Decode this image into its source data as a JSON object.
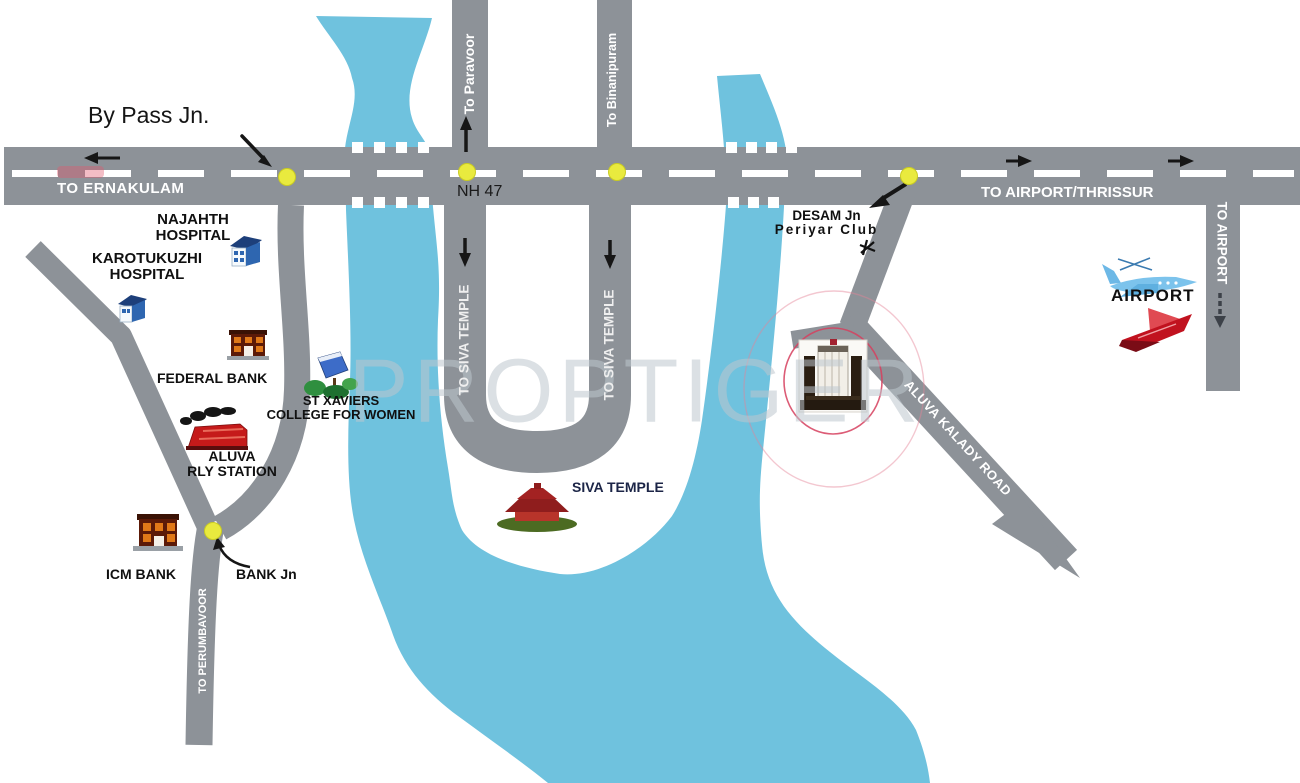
{
  "watermark": "PROPTIGER",
  "roads": {
    "highway_name": "NH 47",
    "labels": {
      "to_ernakulam": "TO ERNAKULAM",
      "to_airport_thrissur": "TO AIRPORT/THRISSUR",
      "to_paravoor": "To Paravoor",
      "to_binanipuram": "To Binanipuram",
      "to_siva_temple": "TO SIVA TEMPLE",
      "to_perumbavoor": "TO PERUMBAVOOR",
      "to_airport": "TO AIRPORT",
      "aluva_kalady_road": "ALUVA KALADY ROAD"
    }
  },
  "junctions": {
    "by_pass": "By Pass Jn.",
    "bank": "BANK Jn",
    "desam_line1": "DESAM Jn",
    "desam_line2": "Periyar Club"
  },
  "places": {
    "najahth_line1": "NAJAHTH",
    "najahth_line2": "HOSPITAL",
    "karotukuzhi_line1": "KAROTUKUZHI",
    "karotukuzhi_line2": "HOSPITAL",
    "federal_bank": "FEDERAL BANK",
    "st_xaviers_line1": "ST XAVIERS",
    "st_xaviers_line2": "COLLEGE FOR WOMEN",
    "aluva_rly_line1": "ALUVA",
    "aluva_rly_line2": "RLY STATION",
    "icm_bank": "ICM BANK",
    "siva_temple": "SIVA TEMPLE",
    "airport": "AIRPORT"
  },
  "icons": {
    "najahth-hospital-icon": "blue hospital building",
    "karotukuzhi-hospital-icon": "blue hospital building",
    "federal-bank-icon": "brick bank building",
    "icm-bank-icon": "brick bank building",
    "st-xaviers-college-icon": "college building with trees",
    "aluva-rly-station-icon": "red steam train",
    "siva-temple-icon": "red temple",
    "project-location-icon": "monument building with red rings",
    "periyar-club-icon": "small black marker",
    "airport-plane-blue-icon": "blue airplane",
    "airport-plane-red-icon": "red airplane"
  },
  "colors": {
    "river": "#6FC2DE",
    "road": "#8D9298",
    "junction_dot": "#E9EA3E",
    "marker_ring": "#D6405E"
  }
}
